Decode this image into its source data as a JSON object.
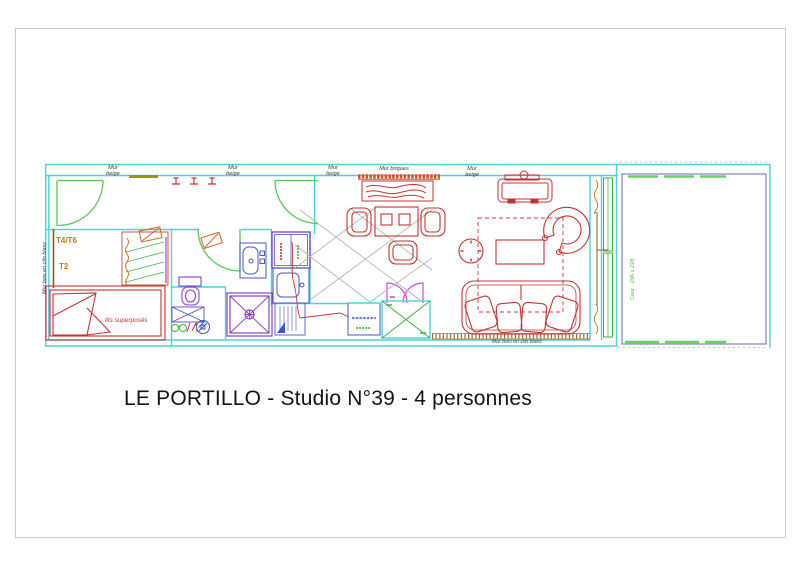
{
  "title": "LE PORTILLO - Studio N°39 - 4 personnes",
  "walls": {
    "mur": "Mur",
    "beige": "beige",
    "mur_briques": "Mur briques",
    "mur_bois_en_clin_blanc": "Mur bois en clin blanc"
  },
  "rooms": {
    "unit_type_1": "T4/T6",
    "unit_type_2": "T2",
    "bunk_beds": "lits superposés",
    "court_dimension": "Cour : 296 x 228"
  },
  "colors": {
    "wall_cyan": "#49d6d6",
    "door_green": "#57c857",
    "furniture_red": "#c83232",
    "sanitary_purple": "#8a3fc8",
    "kitchen_blue": "#4a55cc",
    "wood_brown": "#a86a30",
    "brick_orange": "#d4551e",
    "label_orange": "#c97a12",
    "magenta_door": "#d44ad4",
    "court_border": "#6a6aae",
    "grid_gray": "#b5b5b5",
    "olive_mat": "#9a9a00"
  }
}
